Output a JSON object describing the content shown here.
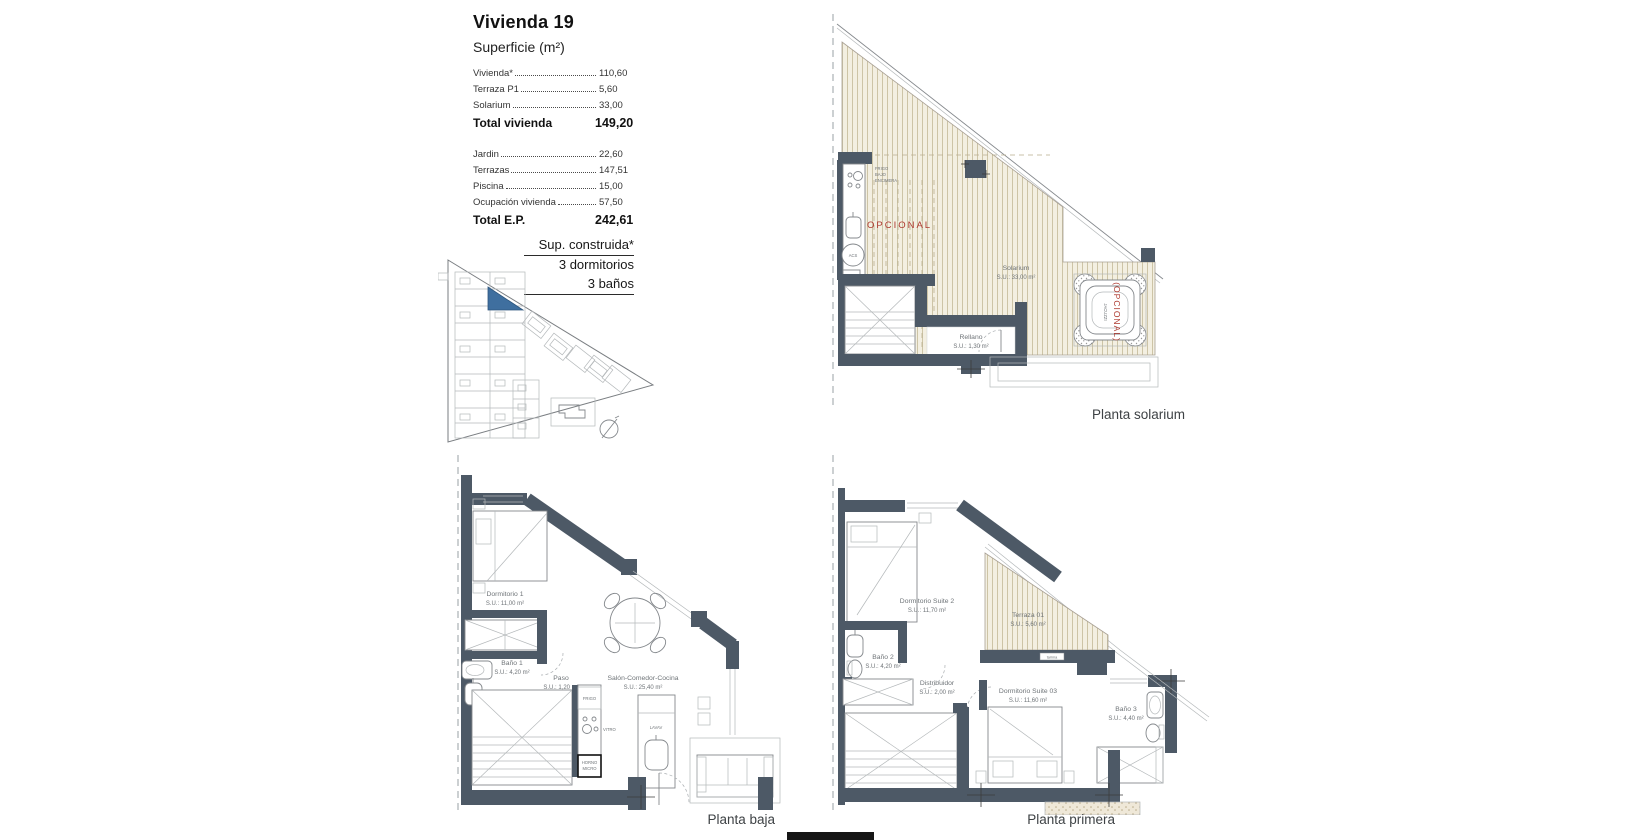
{
  "header": {
    "title": "Vivienda 19",
    "subtitle": "Superficie (m²)",
    "rows": [
      {
        "label": "Vivienda*",
        "value": "110,60"
      },
      {
        "label": "Terraza P1",
        "value": "5,60"
      },
      {
        "label": "Solarium",
        "value": "33,00"
      }
    ],
    "total1_label": "Total vivienda",
    "total1_value": "149,20",
    "rows2": [
      {
        "label": "Jardin",
        "value": "22,60"
      },
      {
        "label": "Terrazas",
        "value": "147,51"
      },
      {
        "label": "Piscina",
        "value": "15,00"
      },
      {
        "label": "Ocupación vivienda",
        "value": "57,50"
      }
    ],
    "total2_label": "Total E.P.",
    "total2_value": "242,61"
  },
  "spec": {
    "line1": "Sup. construida*",
    "line2": "3 dormitorios",
    "line3": "3 baños"
  },
  "solarium": {
    "caption": "Planta solarium",
    "kitchen_note1": "FRIGO",
    "kitchen_note2": "BAJO",
    "kitchen_note3": "ENCIMERA",
    "opcional": "OPCIONAL",
    "acs": "ACS",
    "room_name": "Solarium",
    "room_area": "S.U.: 33,00 m²",
    "rellano_name": "Rellano",
    "rellano_area": "S.U.: 1,30 m²",
    "jacuzzi_opcional": "(OPCIONAL)",
    "jacuzzi_label": "JACUZZI"
  },
  "baja": {
    "caption": "Planta baja",
    "dorm1_name": "Dormitorio 1",
    "dorm1_area": "S.U.: 11,00 m²",
    "bano1_name": "Baño 1",
    "bano1_area": "S.U.: 4,20 m²",
    "paso_name": "Paso",
    "paso_area": "S.U.: 1,20 m²",
    "salon_name": "Salón-Comedor-Cocina",
    "salon_area": "S.U.: 25,40 m²",
    "frigo": "FRIGO",
    "vitro": "VITRO",
    "horno1": "HORNO",
    "horno2": "MICRO",
    "lavav": "LAVAV"
  },
  "primera": {
    "caption": "Planta primera",
    "suite2_name": "Dormitorio Suite 2",
    "suite2_area": "S.U.: 11,70 m²",
    "terraza_name": "Terraza 01",
    "terraza_area": "S.U.: 5,60 m²",
    "bano2_name": "Baño 2",
    "bano2_area": "S.U.: 4,20 m²",
    "distribuidor_name": "Distribuidor",
    "distribuidor_area": "S.U.: 2,00 m²",
    "suite03_name": "Dormitorio Suite 03",
    "suite03_area": "S.U.: 11,60 m²",
    "bano3_name": "Baño 3",
    "bano3_area": "S.U.: 4,40 m²",
    "tarima": "tarima"
  },
  "colors": {
    "wall": "#4d5966",
    "deck_bg": "#f3efe1",
    "deck_line": "#c9c09f",
    "highlight_blue": "#3f6f9f",
    "accent_red": "#ae3a30"
  }
}
